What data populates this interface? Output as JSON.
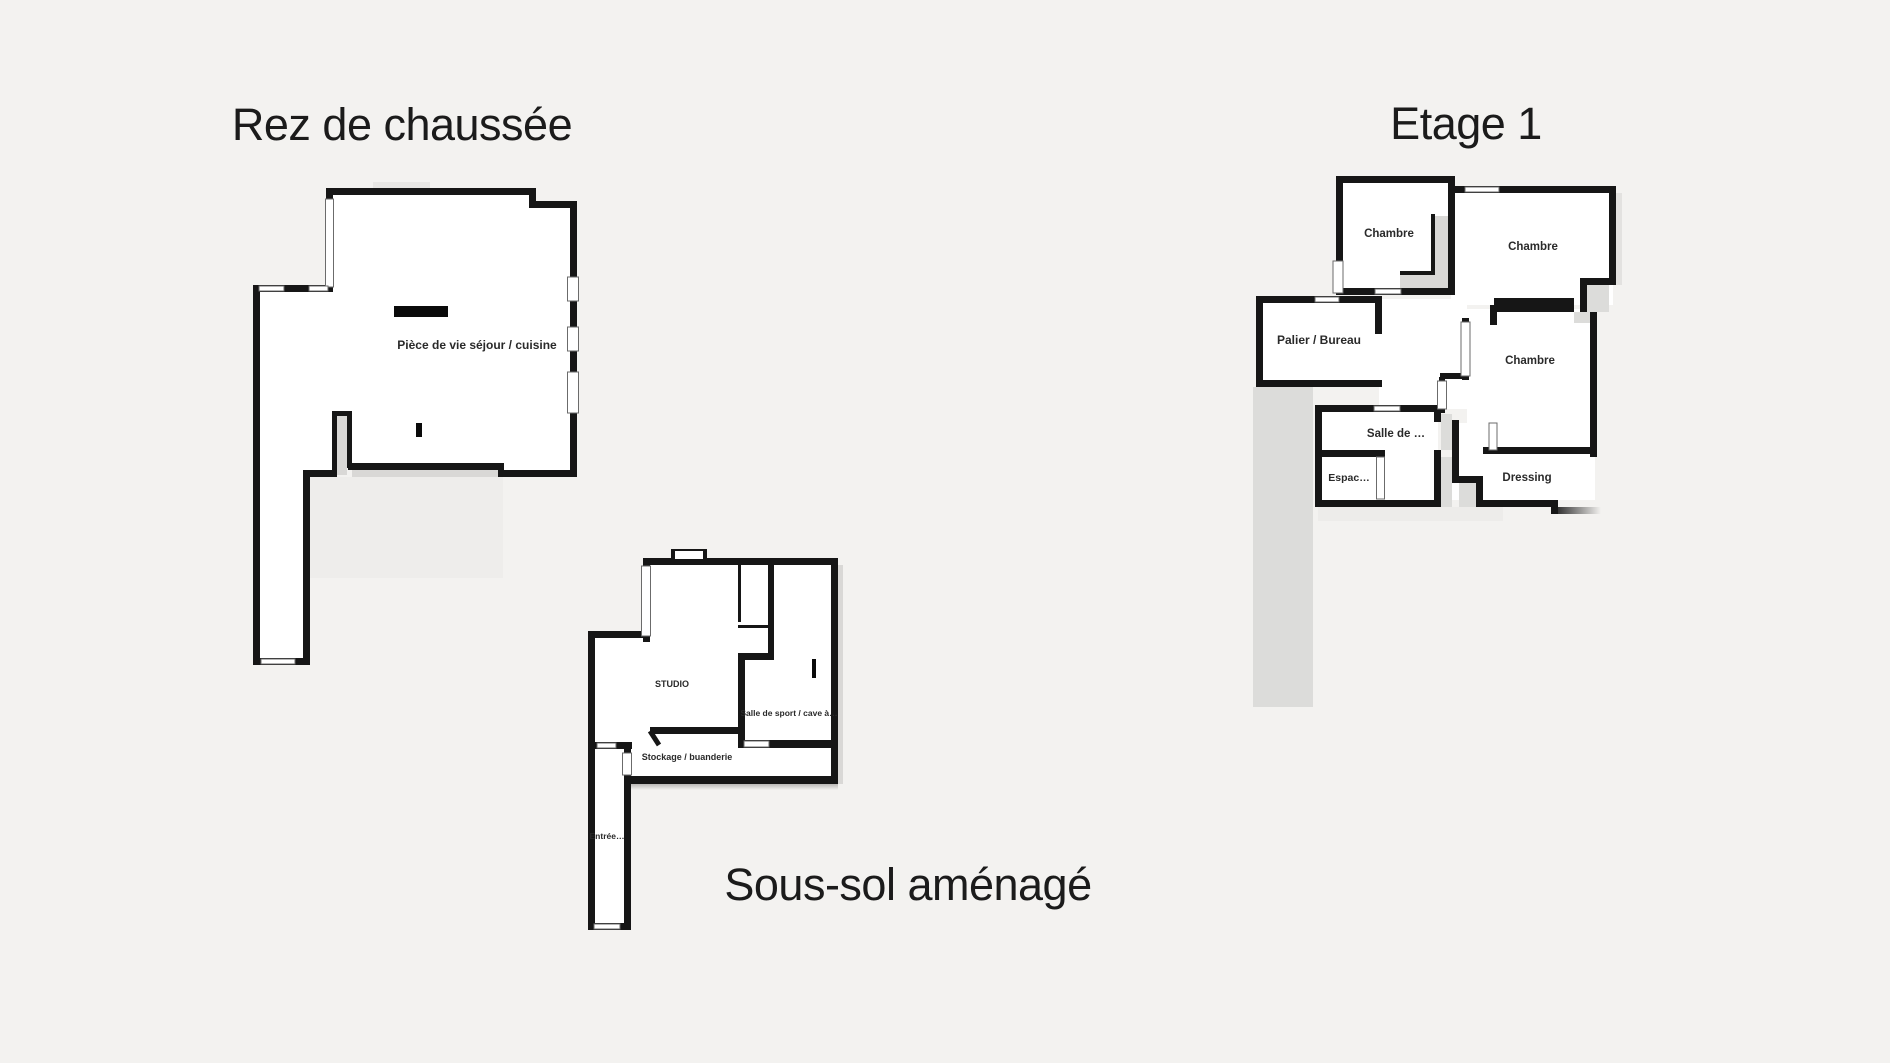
{
  "canvas": {
    "background": "#f3f2f0",
    "wall_color": "#161616",
    "room_fill": "#ffffff",
    "shadow_color": "#d9d8d6",
    "window_fill": "#ffffff"
  },
  "floors": {
    "ground": {
      "title": "Rez de chaussée",
      "rooms": {
        "living": {
          "label": "Pièce de vie séjour / cuisine"
        }
      }
    },
    "first": {
      "title": "Etage 1",
      "rooms": {
        "bedroom1": {
          "label": "Chambre"
        },
        "bedroom2": {
          "label": "Chambre"
        },
        "landing": {
          "label": "Palier / Bureau"
        },
        "bedroom3": {
          "label": "Chambre"
        },
        "bathroom": {
          "label": "Salle de …"
        },
        "space": {
          "label": "Espac…"
        },
        "dressing": {
          "label": "Dressing"
        }
      }
    },
    "basement": {
      "title": "Sous-sol aménagé",
      "rooms": {
        "studio": {
          "label": "STUDIO"
        },
        "gym": {
          "label": "Salle de sport / cave à…"
        },
        "storage": {
          "label": "Stockage / buanderie"
        },
        "entry": {
          "label": "Entrée…"
        }
      }
    }
  }
}
